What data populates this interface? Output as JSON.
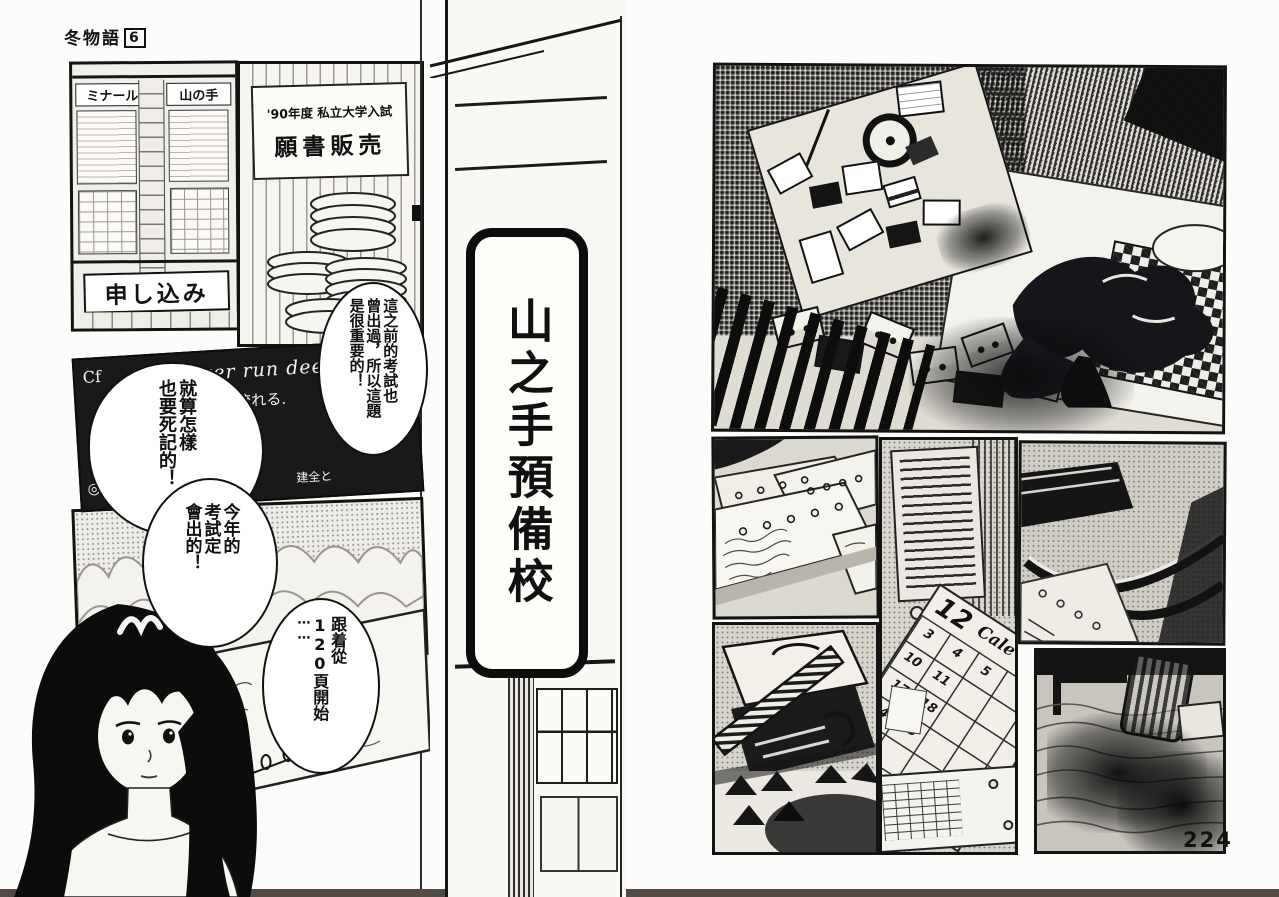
{
  "page": {
    "series_title": "冬物語",
    "volume_badge": "6",
    "page_number": "224"
  },
  "left_page": {
    "building_panel": {
      "sign_left": "ミナール",
      "sign_right": "山の手",
      "banner": "申し込み"
    },
    "poster_panel": {
      "line1": "'90年度 私立大学入試",
      "line2": "願書販売"
    },
    "blackboard": {
      "prefix": "Cf",
      "english1": "still river run deep",
      "japanese1": "は 深く流れる.",
      "english2": "⋯ with",
      "japanese2": "根ぅ種類の",
      "mark": "◎",
      "japanese3": "建全と"
    },
    "bubble1_cols": [
      "這之前的考試也",
      "曾出過，所以這題",
      "是很重要的！"
    ],
    "bubble2_cols": [
      "就算怎樣",
      "也要死記的！"
    ],
    "bubble3_cols": [
      "今年的",
      "考試定",
      "會出的！"
    ],
    "bubble4_cols": [
      "跟着從",
      "120頁開始",
      "⋯⋯"
    ],
    "prep_school_sign": "山之手預備校"
  },
  "right_page": {
    "calendar": {
      "month": "12",
      "script": "Cale",
      "days": [
        "3",
        "4",
        "5",
        "10",
        "11",
        "17",
        "18",
        "24",
        "25"
      ]
    }
  }
}
